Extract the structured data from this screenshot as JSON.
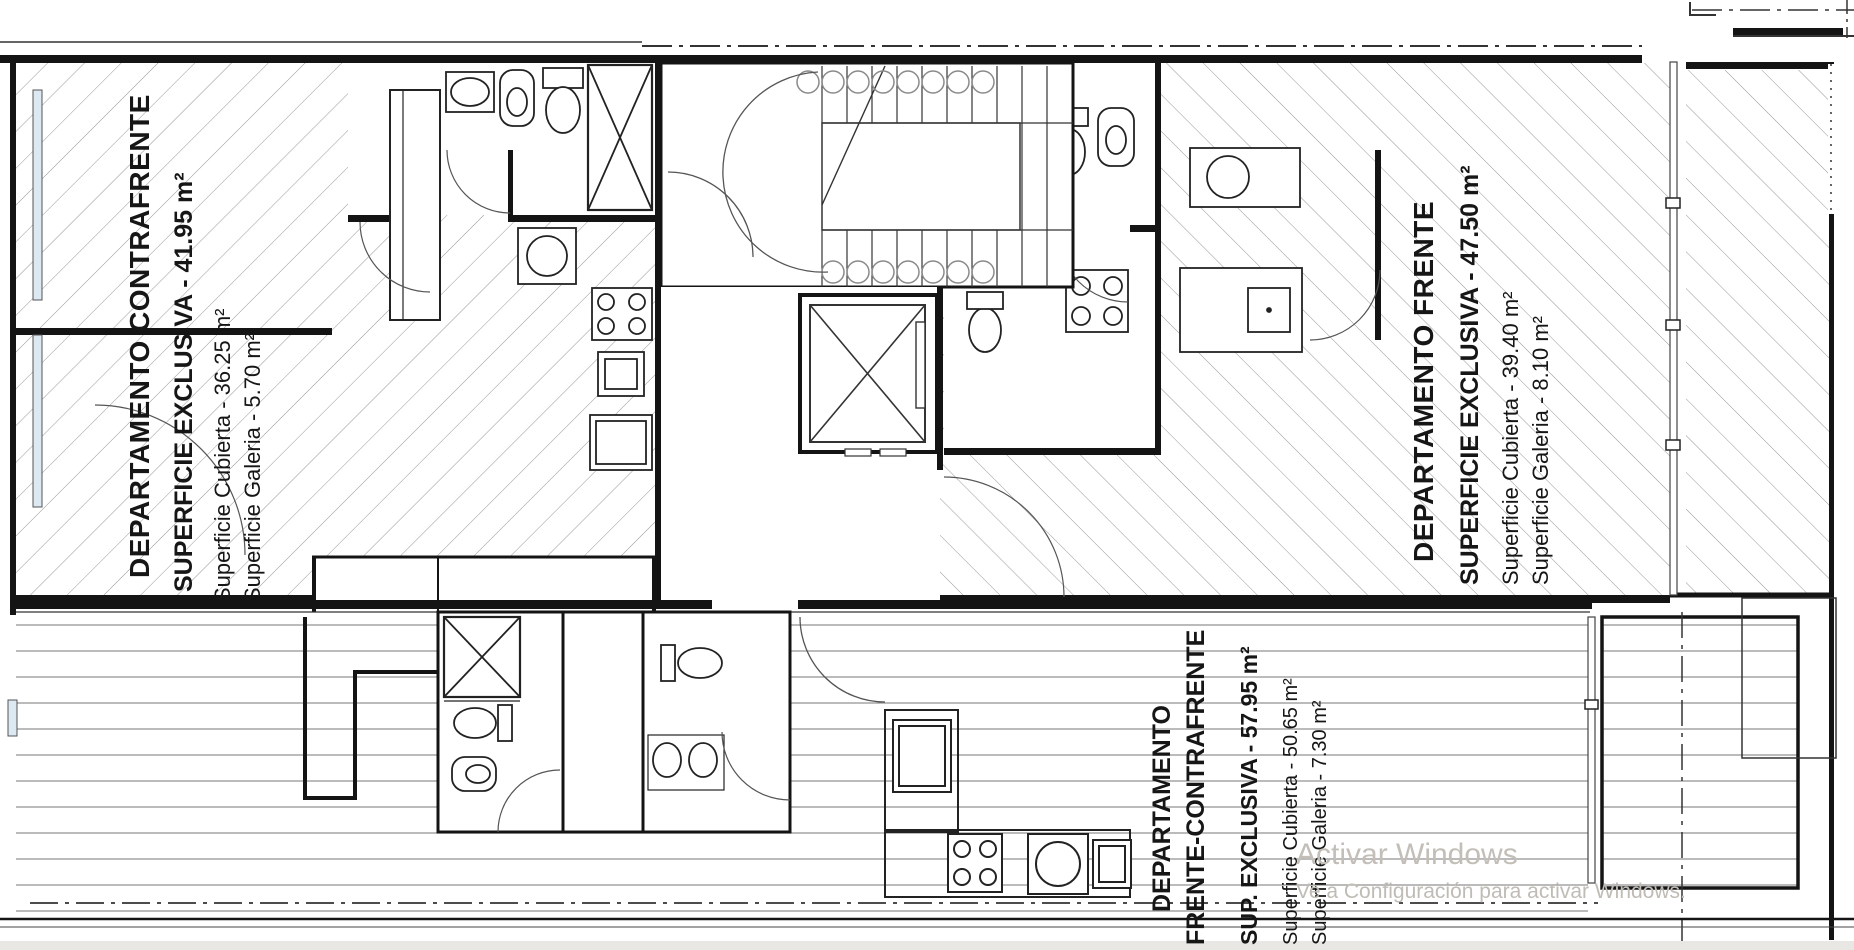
{
  "apartments": {
    "contrafrente": {
      "title": "DEPARTAMENTO CONTRAFRENTE",
      "superficie_exclusiva": "SUPERFICIE EXCLUSIVA - 41.95 m²",
      "superficie_cubierta": "Superficie Cubierta - 36.25 m²",
      "superficie_galeria": "Superficie Galeria - 5.70 m²"
    },
    "frente": {
      "title": "DEPARTAMENTO FRENTE",
      "superficie_exclusiva": "SUPERFICIE EXCLUSIVA - 47.50 m²",
      "superficie_cubierta": "Superficie Cubierta - 39.40 m²",
      "superficie_galeria": "Superficie Galeria - 8.10 m²"
    },
    "frente_contrafrente": {
      "title_line1": "DEPARTAMENTO",
      "title_line2": "FRENTE-CONTRAFRENTE",
      "superficie_exclusiva": "SUP. EXCLUSIVA - 57.95 m²",
      "superficie_cubierta": "Superficie Cubierta - 50.65 m²",
      "superficie_galeria": "Superficie Galeria - 7.30 m²"
    }
  },
  "watermark": {
    "line1": "Activar Windows",
    "line2": "Ve a Configuración para activar Windows."
  }
}
